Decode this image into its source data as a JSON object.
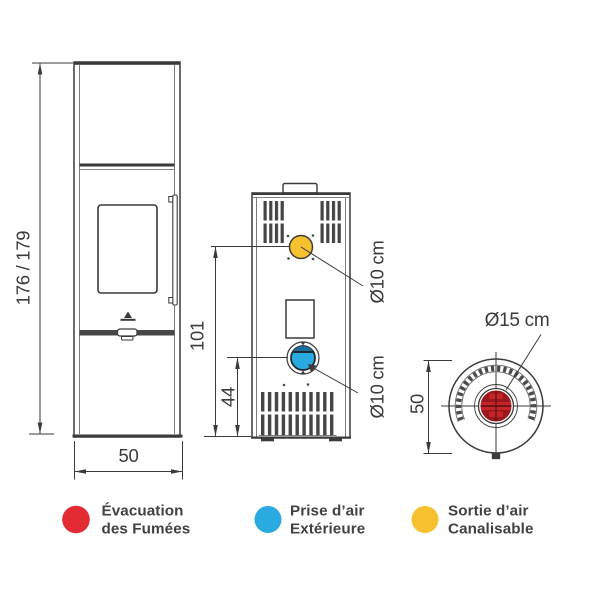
{
  "colors": {
    "line": "#3a3a3a",
    "text": "#414042",
    "red": "#e32b33",
    "blue": "#29abe2",
    "yellow": "#f5c12f",
    "red_duct_base": "#c6232b",
    "red_duct_dark": "#9a171d"
  },
  "front_view": {
    "height_label": "176 / 179",
    "width_label": "50"
  },
  "rear_view": {
    "height_label": "101",
    "intake_height_label": "44",
    "canalisable_duct_label": "Ø10 cm",
    "intake_duct_label": "Ø10 cm"
  },
  "top_view": {
    "flue_label": "Ø15 cm",
    "depth_label": "50"
  },
  "legend": {
    "items": [
      {
        "line1": "Évacuation",
        "line2": "des Fumées",
        "color": "#e32b33"
      },
      {
        "line1": "Prise d’air",
        "line2": "Extérieure",
        "color": "#29abe2"
      },
      {
        "line1": "Sortie d’air",
        "line2": "Canalisable",
        "color": "#f5c12f"
      }
    ]
  }
}
